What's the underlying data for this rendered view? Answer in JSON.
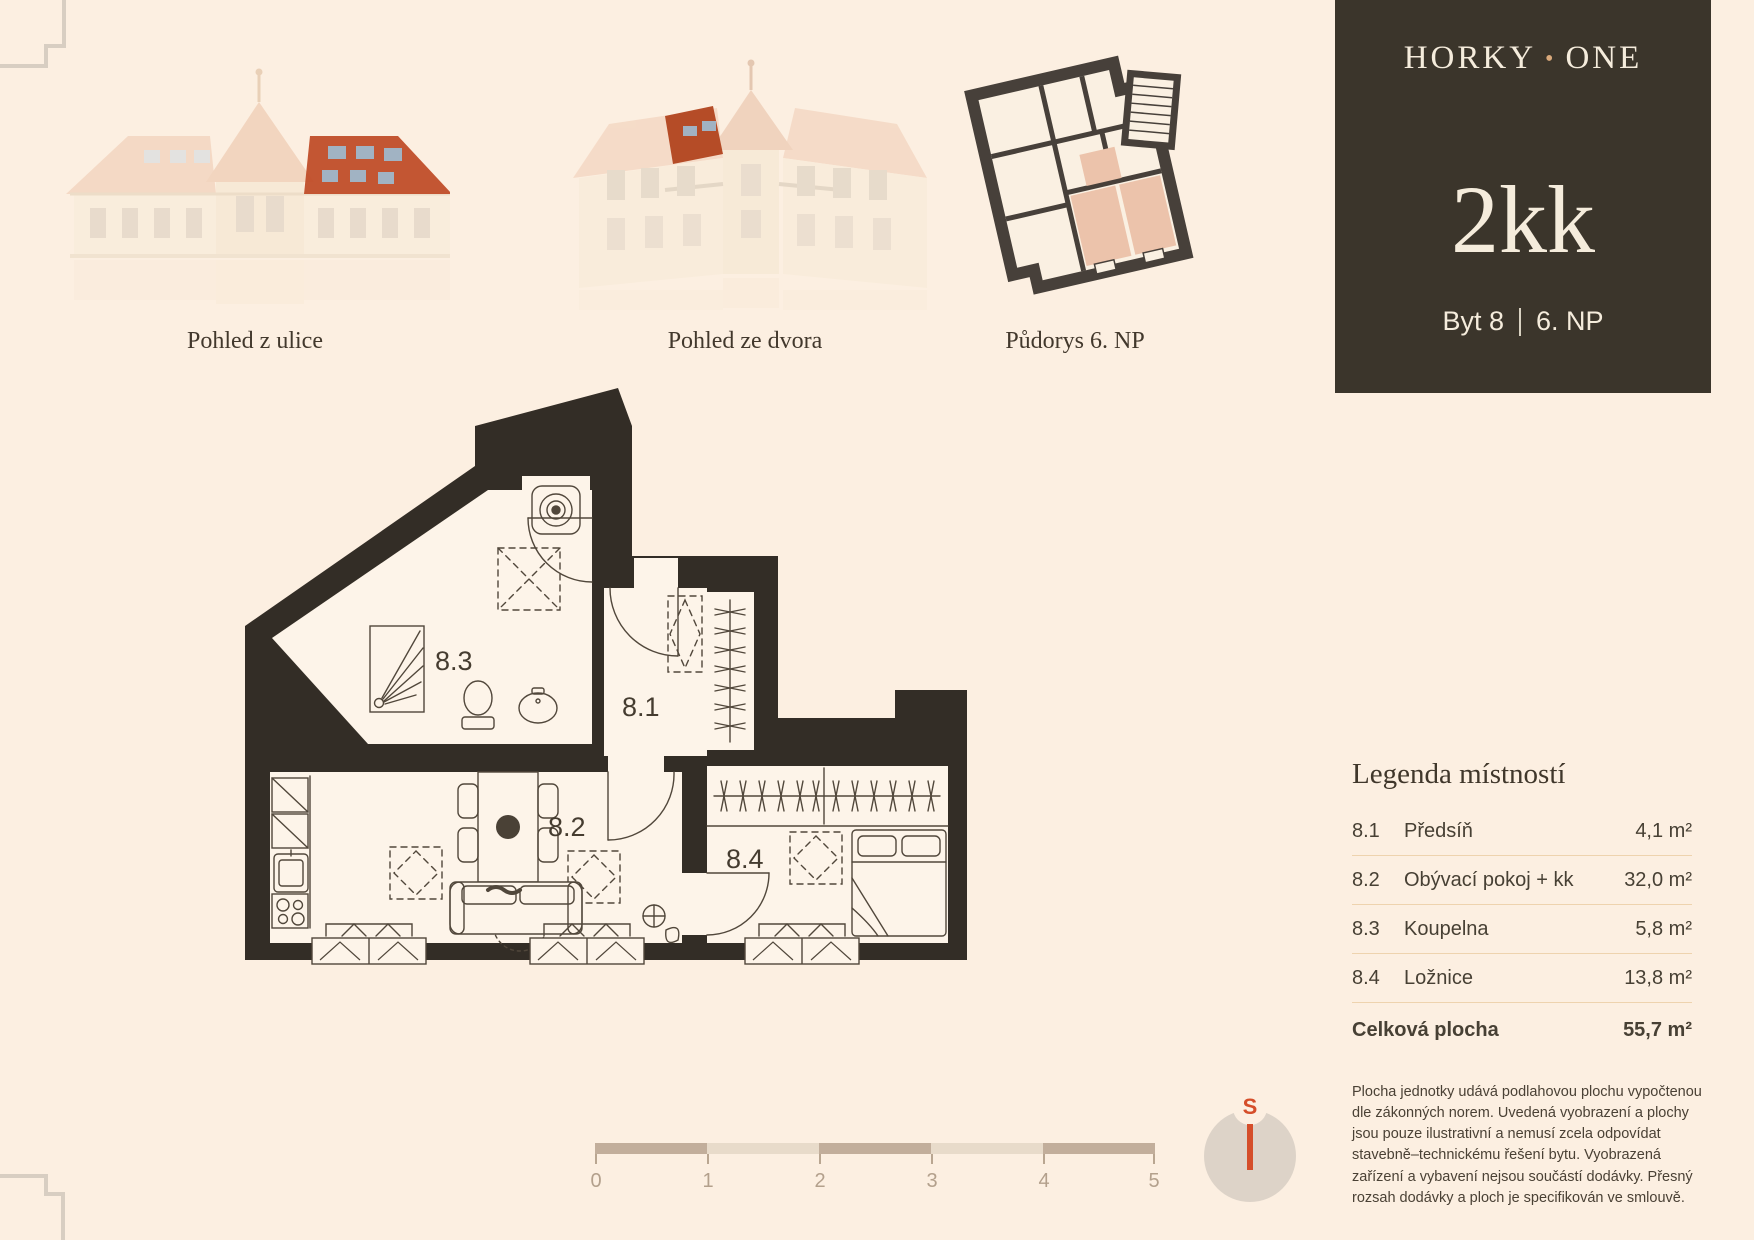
{
  "brand": {
    "horky": "HORKY",
    "dot": "•",
    "one": "ONE",
    "unit_type": "2kk",
    "unit_no": "Byt 8",
    "floor": "6. NP"
  },
  "captions": {
    "street": "Pohled z ulice",
    "courtyard": "Pohled ze dvora",
    "overview": "Půdorys 6. NP"
  },
  "plan": {
    "rooms": {
      "r81": "8.1",
      "r82": "8.2",
      "r83": "8.3",
      "r84": "8.4"
    }
  },
  "legend": {
    "title": "Legenda místností",
    "rows": [
      {
        "no": "8.1",
        "name": "Předsíň",
        "area": "4,1 m²"
      },
      {
        "no": "8.2",
        "name": "Obývací pokoj + kk",
        "area": "32,0 m²"
      },
      {
        "no": "8.3",
        "name": "Koupelna",
        "area": "5,8 m²"
      },
      {
        "no": "8.4",
        "name": "Ložnice",
        "area": "13,8 m²"
      }
    ],
    "total": {
      "label": "Celková plocha",
      "value": "55,7 m²"
    }
  },
  "disclaimer": "Plocha jednotky udává podlahovou plochu vypočtenou dle zákonných norem. Uvedená vyobrazení a plochy jsou pouze ilustrativní a nemusí zcela odpovídat stavebně–technickému řešení bytu. Vyobrazená zařízení a vybavení nejsou součástí dodávky. Přesný rozsah dodávky a ploch je specifikován ve smlouvě.",
  "scalebar": {
    "labels": [
      "0",
      "1",
      "2",
      "3",
      "4",
      "5"
    ]
  },
  "compass": {
    "label": "S"
  },
  "colors": {
    "background": "#fcefe1",
    "box": "#3b352b",
    "cream": "#f5ecdc",
    "gold_dot": "#d9a97b",
    "wall": "#332d26",
    "room": "#fdf4e9",
    "furniture": "#51473b",
    "highlight_red_roof": "#c14e2a",
    "unit_pink": "#ecc3ab",
    "scale_dark": "#c2ae9b",
    "scale_light": "#e8dbca",
    "compass_red": "#d54e2a"
  }
}
